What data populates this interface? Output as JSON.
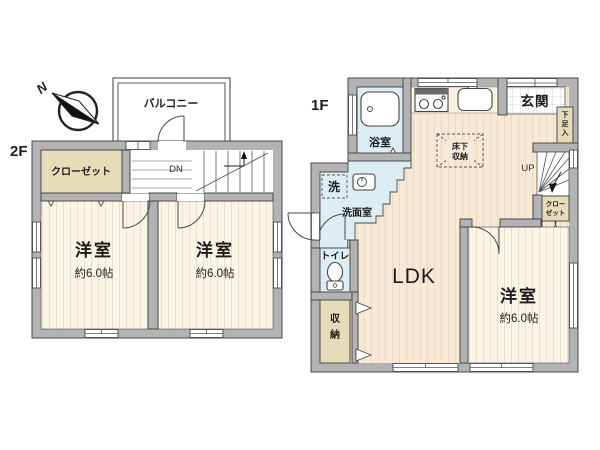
{
  "colors": {
    "wall": "#b3b3b3",
    "wall_outline": "#4a4a4a",
    "room_cream": "#faf5e6",
    "room_stripe": "#e7e1cc",
    "ldk_peach": "#f8e9d6",
    "ldk_stripe": "#edd9c2",
    "wet_blue": "#ddedf4",
    "closet_beige": "#e6dcba",
    "counter_cream": "#f9f2e2",
    "text": "#1c1c1c"
  },
  "floor2": {
    "label": "2F",
    "north": "N",
    "balcony": "バルコニー",
    "closet": "クローゼット",
    "dn": "DN",
    "room_left": {
      "name": "洋室",
      "size": "約6.0帖"
    },
    "room_right": {
      "name": "洋室",
      "size": "約6.0帖"
    }
  },
  "floor1": {
    "label": "1F",
    "bath": "浴室",
    "laundry": "洗",
    "washroom": "洗面室",
    "toilet": "トイレ",
    "storage": [
      "収",
      "納"
    ],
    "ldk": "LDK",
    "room": {
      "name": "洋室",
      "size": "約6.0帖"
    },
    "entrance": "玄関",
    "shoe_cabinet": [
      "下",
      "足",
      "入"
    ],
    "underfloor": [
      "床下",
      "収納"
    ],
    "up": "UP",
    "closet": [
      "クロー",
      "ゼット"
    ]
  }
}
